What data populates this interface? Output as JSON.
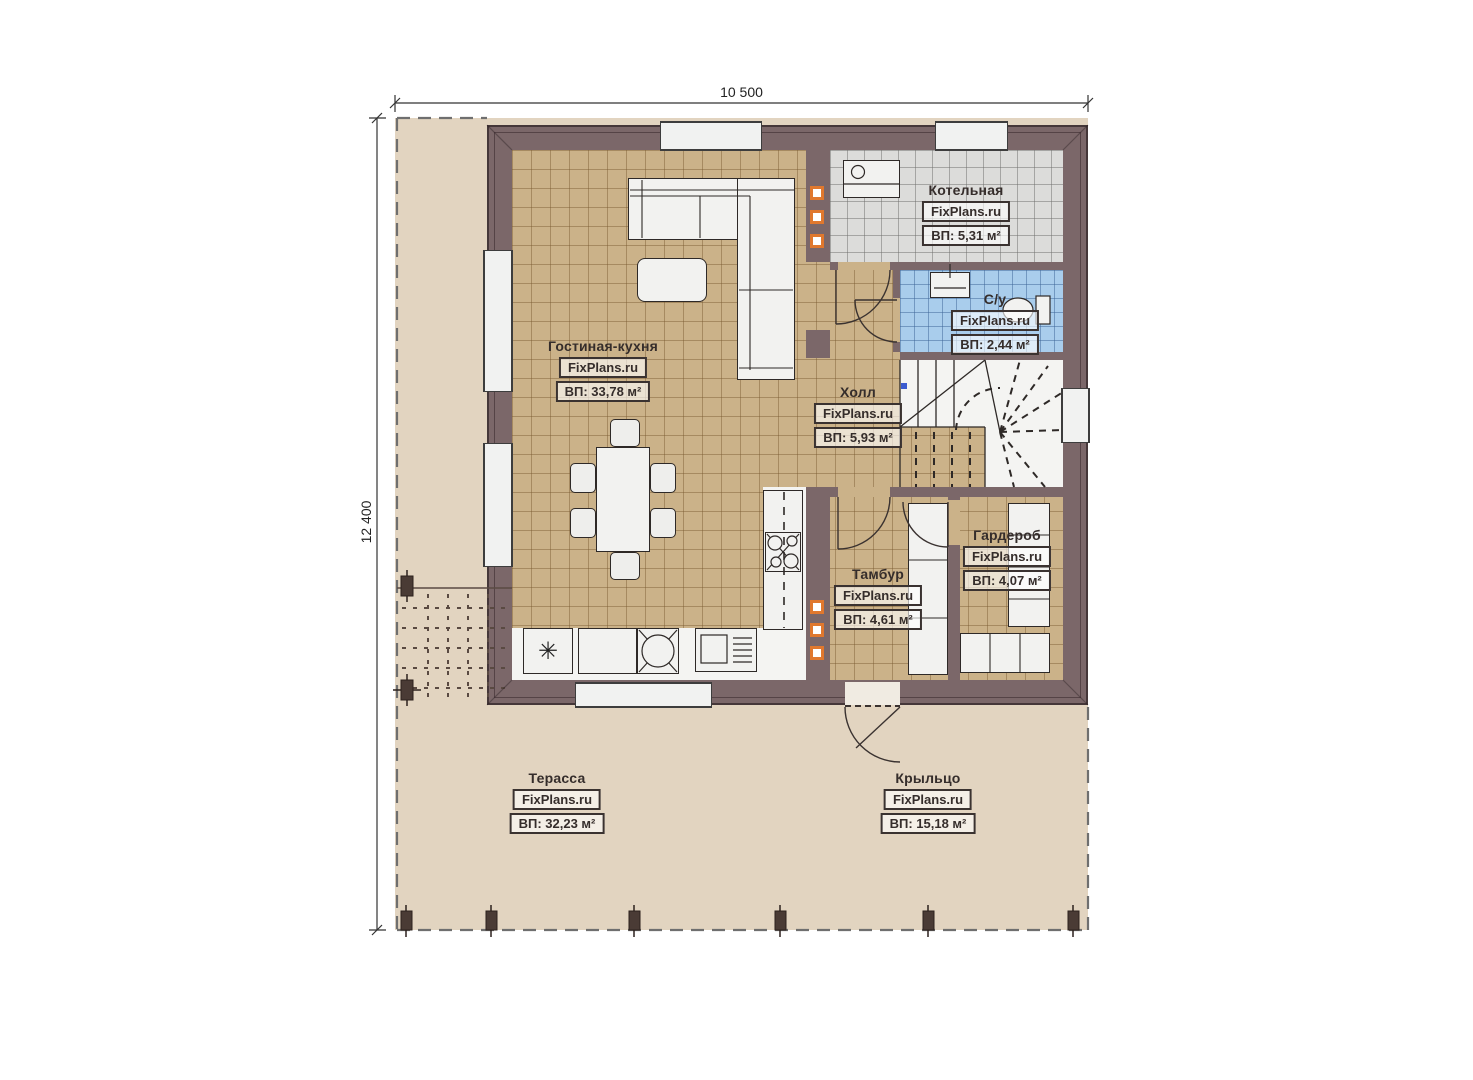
{
  "watermark": "FixPlans.ru",
  "dimensions": {
    "top": "10 500",
    "left": "12 400"
  },
  "rooms": {
    "living": {
      "name": "Гостиная-кухня",
      "area": "ВП: 33,78 м²"
    },
    "boiler": {
      "name": "Котельная",
      "area": "ВП: 5,31 м²"
    },
    "bathroom": {
      "name": "С/у",
      "area": "ВП: 2,44 м²"
    },
    "hall": {
      "name": "Холл",
      "area": "ВП: 5,93 м²"
    },
    "wardrobe": {
      "name": "Гардероб",
      "area": "ВП: 4,07 м²"
    },
    "vestibule": {
      "name": "Тамбур",
      "area": "ВП: 4,61 м²"
    },
    "terrace": {
      "name": "Терасса",
      "area": "ВП: 32,23 м²"
    },
    "porch": {
      "name": "Крыльцо",
      "area": "ВП: 15,18 м²"
    }
  },
  "icons": {
    "fridge": "✳"
  },
  "colors": {
    "wall": "#7b6769",
    "floor_tiles": "#cbb289",
    "boiler_tiles": "#dcdcda",
    "bath_tiles": "#a9cdec",
    "site": "#e2d4c0",
    "vent_accent": "#e0782e"
  }
}
